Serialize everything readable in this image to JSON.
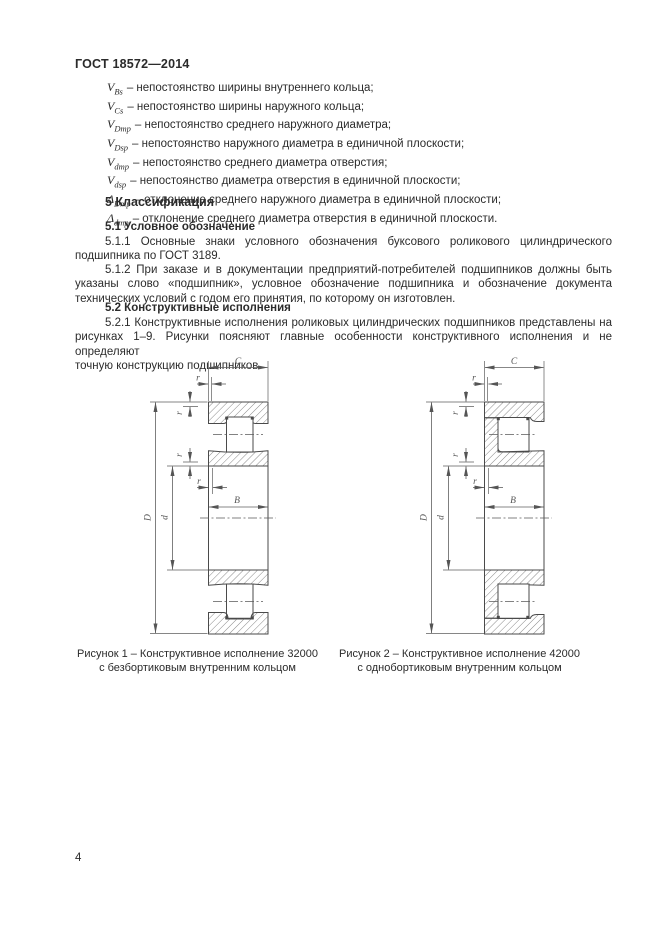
{
  "header": {
    "title": "ГОСТ 18572—2014"
  },
  "definitions": [
    {
      "sym": "V",
      "sub": "Bs",
      "text": "– непостоянство ширины внутреннего кольца;"
    },
    {
      "sym": "V",
      "sub": "Cs",
      "text": "– непостоянство ширины наружного кольца;"
    },
    {
      "sym": "V",
      "sub": "Dmp",
      "text": "– непостоянство среднего наружного диаметра;"
    },
    {
      "sym": "V",
      "sub": "Dsp",
      "text": "– непостоянство наружного диаметра в единичной плоскости;"
    },
    {
      "sym": "V",
      "sub": "dmp",
      "text": "– непостоянство среднего диаметра отверстия;"
    },
    {
      "sym": "V",
      "sub": "dsp",
      "text": "– непостоянство диаметра отверстия в единичной плоскости;"
    },
    {
      "sym": "Δ",
      "sub": "Dmp",
      "text": "– отклонение среднего наружного диаметра в единичной плоскости;"
    },
    {
      "sym": "Δ",
      "sub": "dmp",
      "text": "– отклонение среднего диаметра отверстия в единичной плоскости."
    }
  ],
  "section": {
    "heading": "5 Классификация",
    "sub1_heading": "5.1 Условное обозначение",
    "p511": [
      "5.1.1 Основные знаки условного обозначения буксового роликового цилиндрического",
      "подшипника по ГОСТ 3189."
    ],
    "p512": [
      "5.1.2 При заказе и в документации предприятий-потребителей подшипников должны быть",
      "указаны слово «подшипник», условное обозначение подшипника и обозначение документа",
      "технических условий с годом его принятия, по которому он изготовлен."
    ],
    "sub2_heading": "5.2 Конструктивные исполнения",
    "p521": [
      "5.2.1 Конструктивные исполнения роликовых цилиндрических подшипников представлены на",
      "рисунках 1–9. Рисунки поясняют главные особенности конструктивного исполнения и не определяют",
      "точную конструкцию подшипников."
    ]
  },
  "figures": {
    "dim_labels": {
      "outer_width": "C",
      "chamfer": "r",
      "inner_width": "B",
      "outer_diameter": "D",
      "bore_diameter": "d"
    },
    "fig1": {
      "caption_line1": "Рисунок 1 – Конструктивное исполнение 32000",
      "caption_line2": "с безбортиковым внутренним кольцом"
    },
    "fig2": {
      "caption_line1": "Рисунок 2 – Конструктивное исполнение 42000",
      "caption_line2": "с однобортиковым внутренним кольцом"
    }
  },
  "page": {
    "number": "4"
  }
}
